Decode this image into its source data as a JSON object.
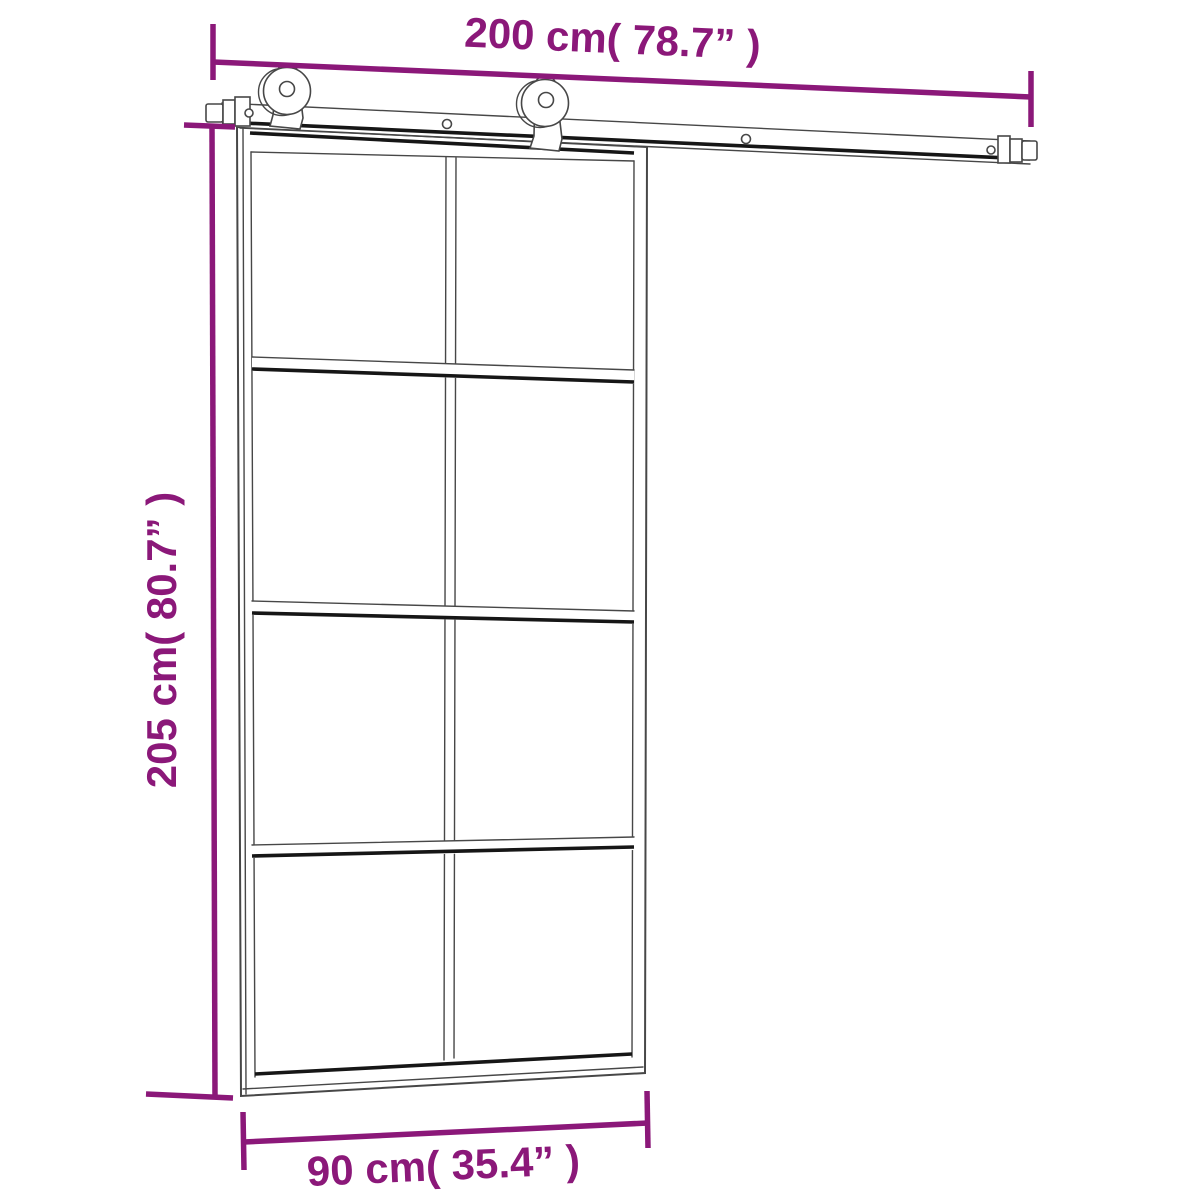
{
  "page": {
    "background": "#ffffff"
  },
  "diagram": {
    "type": "sliding-door-dimension-drawing",
    "labels": {
      "rail_width": "200 cm( 78.7” )",
      "door_height": "205 cm( 80.7” )",
      "door_width": "90 cm( 35.4” )"
    },
    "values": {
      "rail_width_cm": 200,
      "rail_width_in": 78.7,
      "door_height_cm": 205,
      "door_height_in": 80.7,
      "door_width_cm": 90,
      "door_width_in": 35.4
    },
    "door": {
      "glass_columns": 2,
      "glass_rows": 4
    },
    "hardware": {
      "rollers": 2,
      "rail_end_stops": 2
    },
    "colors": {
      "dimension": "#8b1879",
      "line": "#474747",
      "line_dark": "#161616",
      "background": "#ffffff"
    }
  }
}
